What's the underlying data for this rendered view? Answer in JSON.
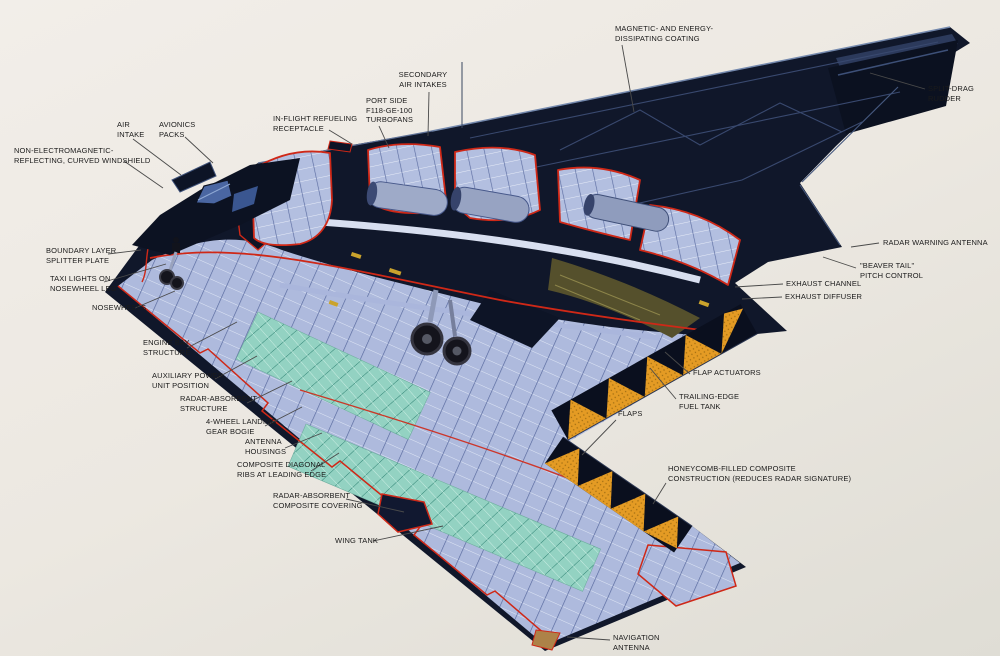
{
  "figure": {
    "subject": "B-2 stealth bomber cutaway illustration"
  },
  "colors": {
    "background": "#EDE9E3",
    "airframe_skin": "#10172A",
    "panel_line_blue": "#3D5078",
    "cutaway_structure_blue": "#B3BFE0",
    "structure_shadow_blue": "#5C6DA1",
    "cutaway_outline_red": "#CF2817",
    "fuel_tank_teal": "#93D2C2",
    "honeycomb_orange": "#E49B24",
    "windshield_blue": "#4A66A2",
    "antenna_fairing_tan": "#AD8248",
    "label_text": "#1B1B1B",
    "leader_line": "#4A4A4A"
  },
  "labels": [
    {
      "id": "magnetic-energy-dissipating-coating",
      "text": "MAGNETIC- AND ENERGY-\nDISSIPATING COATING"
    },
    {
      "id": "split-drag-rudder",
      "text": "SPLIT-DRAG RUDDER"
    },
    {
      "id": "secondary-air-intakes",
      "text": "SECONDARY\nAIR INTAKES"
    },
    {
      "id": "port-side-turbofans",
      "text": "PORT SIDE\nF118-GE-100\nTURBOFANS"
    },
    {
      "id": "in-flight-refueling-receptacle",
      "text": "IN-FLIGHT REFUELING\nRECEPTACLE"
    },
    {
      "id": "avionics-packs",
      "text": "AVIONICS\nPACKS"
    },
    {
      "id": "air-intake",
      "text": "AIR\nINTAKE"
    },
    {
      "id": "curved-windshield",
      "text": "NON-ELECTROMAGNETIC-\nREFLECTING, CURVED WINDSHIELD"
    },
    {
      "id": "boundary-layer-splitter-plate",
      "text": "BOUNDARY LAYER\nSPLITTER PLATE"
    },
    {
      "id": "taxi-lights",
      "text": "TAXI LIGHTS ON\nNOSEWHEEL LEG"
    },
    {
      "id": "nosewheels",
      "text": "NOSEWHEELS"
    },
    {
      "id": "engine-bay-structure",
      "text": "ENGINE BAY\nSTRUCTURE"
    },
    {
      "id": "auxiliary-power-unit",
      "text": "AUXILIARY POWER\nUNIT POSITION"
    },
    {
      "id": "radar-absorbent-structure",
      "text": "RADAR-ABSORBENT\nSTRUCTURE"
    },
    {
      "id": "landing-gear-bogie",
      "text": "4-WHEEL LANDING\nGEAR BOGIE"
    },
    {
      "id": "antenna-housings",
      "text": "ANTENNA\nHOUSINGS"
    },
    {
      "id": "composite-diagonal-ribs",
      "text": "COMPOSITE DIAGONAL\nRIBS AT LEADING EDGE"
    },
    {
      "id": "radar-absorbent-covering",
      "text": "RADAR-ABSORBENT\nCOMPOSITE COVERING"
    },
    {
      "id": "wing-tank",
      "text": "WING TANK"
    },
    {
      "id": "radar-warning-antenna",
      "text": "RADAR WARNING ANTENNA"
    },
    {
      "id": "beaver-tail-pitch-control",
      "text": "\"BEAVER TAIL\"\nPITCH CONTROL"
    },
    {
      "id": "exhaust-channel",
      "text": "EXHAUST CHANNEL"
    },
    {
      "id": "exhaust-diffuser",
      "text": "EXHAUST DIFFUSER"
    },
    {
      "id": "flap-actuators",
      "text": "FLAP ACTUATORS"
    },
    {
      "id": "trailing-edge-fuel-tank",
      "text": "TRAILING-EDGE\nFUEL TANK"
    },
    {
      "id": "flaps",
      "text": "FLAPS"
    },
    {
      "id": "honeycomb-composite",
      "text": "HONEYCOMB-FILLED COMPOSITE\nCONSTRUCTION (REDUCES RADAR SIGNATURE)"
    },
    {
      "id": "navigation-antenna",
      "text": "NAVIGATION\nANTENNA"
    }
  ]
}
